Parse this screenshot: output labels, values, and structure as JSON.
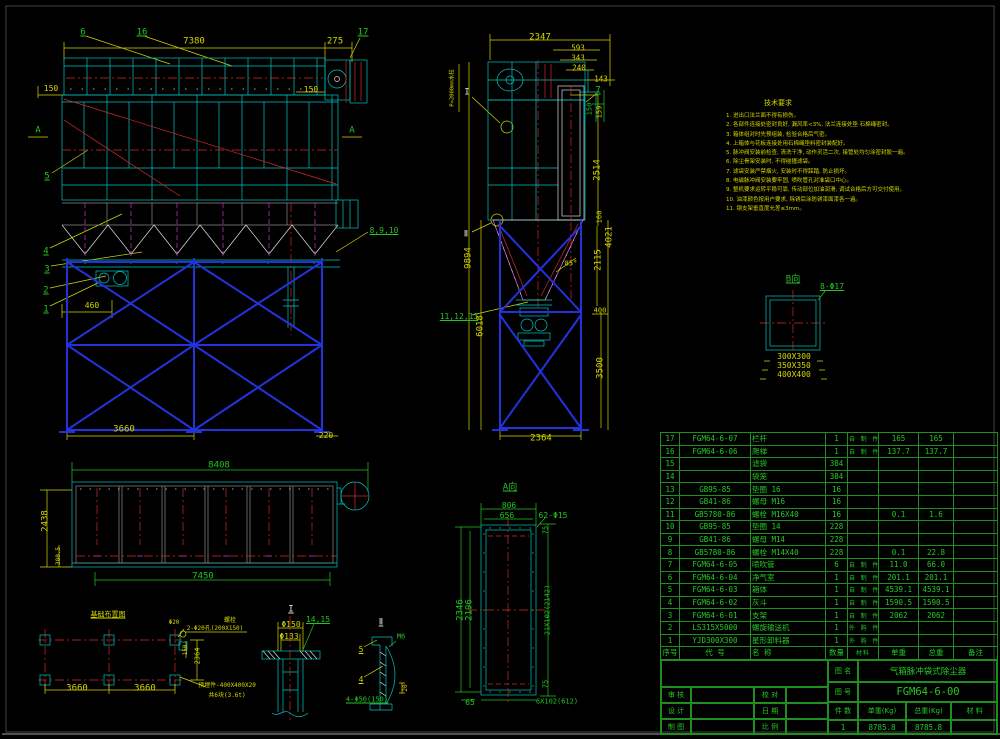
{
  "meta": {
    "drawing_no": "FGM64-6-00",
    "drawing_name": "气箱脉冲袋式除尘器",
    "colors": {
      "line_cyan": "#00c3c3",
      "dim_yellow": "#d6d600",
      "callout_green": "#22c522",
      "center_red": "#d42a2a",
      "frame_blue": "#2233dd",
      "hatch_magenta": "#cc33cc",
      "bg": "#000000"
    }
  },
  "notes": {
    "title": "技术要求",
    "items": [
      "1. 进出口法兰面不得有损伤。",
      "2. 各部件连接处密封良好, 漏风率<3%, 法兰连接处垫 石棉绳密封。",
      "3. 箱体组对时先预组装, 检验合格后气密。",
      "4. 上箱体与花板连接处用石棉绳垫料密封装配好。",
      "5. 脉冲阀安装前检查, 清洗干净, 动作灵活二次, 接管处均匀涂密封胶一遍。",
      "6. 除尘骨架安装时, 不得碰撞滤袋。",
      "7. 滤袋安装严禁烟火, 安装时不得踩踏, 防止损坏。",
      "8. 电磁脉冲阀安装要牢固, 喷吹管孔对准袋口中心。",
      "9. 整机要求运转平稳可靠, 传动部位加油润滑, 调试合格后方可交付使用。",
      "10. 油漆颜色按用户要求, 除锈后涂防锈漆面漆各一遍。",
      "11. 钢支架垂直度允差≤3mm。"
    ]
  },
  "parts_table": {
    "headers": [
      "序号",
      "代 号",
      "名 称",
      "数量",
      "材料",
      "单重",
      "总重",
      "备注"
    ],
    "rows": [
      [
        "17",
        "FGM64-6-07",
        "栏杆",
        "1",
        "自 制 件",
        "165",
        "165",
        ""
      ],
      [
        "16",
        "FGM64-6-06",
        "爬梯",
        "1",
        "自 制 件",
        "137.7",
        "137.7",
        ""
      ],
      [
        "15",
        "",
        "滤袋",
        "384",
        "",
        "",
        "",
        ""
      ],
      [
        "14",
        "",
        "袋笼",
        "384",
        "",
        "",
        "",
        ""
      ],
      [
        "13",
        "GB95-85",
        "垫圈 16",
        "16",
        "",
        "",
        "",
        ""
      ],
      [
        "12",
        "GB41-86",
        "螺母 M16",
        "16",
        "",
        "",
        "",
        ""
      ],
      [
        "11",
        "GB5780-86",
        "螺栓 M16X40",
        "16",
        "",
        "0.1",
        "1.6",
        ""
      ],
      [
        "10",
        "GB95-85",
        "垫圈 14",
        "228",
        "",
        "",
        "",
        ""
      ],
      [
        "9",
        "GB41-86",
        "螺母 M14",
        "228",
        "",
        "",
        "",
        ""
      ],
      [
        "8",
        "GB5780-86",
        "螺栓 M14X40",
        "228",
        "",
        "0.1",
        "22.8",
        ""
      ],
      [
        "7",
        "FGM64-6-05",
        "喷吹管",
        "6",
        "自 制 件",
        "11.0",
        "66.0",
        ""
      ],
      [
        "6",
        "FGM64-6-04",
        "净气室",
        "1",
        "自 制 件",
        "201.1",
        "201.1",
        ""
      ],
      [
        "5",
        "FGM64-6-03",
        "箱体",
        "1",
        "自 制 件",
        "4539.1",
        "4539.1",
        ""
      ],
      [
        "4",
        "FGM64-6-02",
        "灰斗",
        "1",
        "自 制 件",
        "1590.5",
        "1590.5",
        ""
      ],
      [
        "3",
        "FGM64-6-01",
        "支架",
        "1",
        "自 制 件",
        "2062",
        "2062",
        ""
      ],
      [
        "2",
        "LS315X5000",
        "螺旋输送机",
        "1",
        "外 购 件",
        "",
        "",
        ""
      ],
      [
        "1",
        "YJD300X300",
        "星形卸料器",
        "1",
        "外 购 件",
        "",
        "",
        ""
      ]
    ]
  },
  "title_block": {
    "drawing_name_label": "图 名",
    "drawing_name": "气箱脉冲袋式除尘器",
    "drawing_no_label": "图 号",
    "drawing_no": "FGM64-6-00",
    "review_label": "审 核",
    "proof_label": "校 对",
    "design_label": "设 计",
    "date_label": "日 期",
    "draft_label": "制 图",
    "scale_label": "比 例",
    "qty_label": "件 数",
    "unit_weight_label": "单重(Kg)",
    "total_weight_label": "总重(Kg)",
    "material_label": "材 料",
    "qty": "1",
    "unit_weight": "8785.8",
    "total_weight": "8785.8"
  },
  "labels": [
    {
      "n": "callout-6",
      "t": "6",
      "x": 83,
      "y": 33,
      "c": "g",
      "u": 1
    },
    {
      "n": "callout-16",
      "t": "16",
      "x": 142,
      "y": 33,
      "c": "g",
      "u": 1
    },
    {
      "n": "dim-7380",
      "t": "7380",
      "x": 194,
      "y": 42,
      "c": "y"
    },
    {
      "n": "dim-275",
      "t": "275",
      "x": 335,
      "y": 42,
      "c": "y"
    },
    {
      "n": "callout-17",
      "t": "17",
      "x": 363,
      "y": 33,
      "c": "g",
      "u": 1
    },
    {
      "n": "dim-150-left",
      "t": "150",
      "x": 51,
      "y": 89,
      "c": "y",
      "s": 8
    },
    {
      "n": "dim-150-right",
      "t": "150",
      "x": 311,
      "y": 90,
      "c": "y",
      "s": 8
    },
    {
      "n": "section-a-left",
      "t": "A",
      "x": 38,
      "y": 131,
      "c": "g"
    },
    {
      "n": "section-a-right",
      "t": "A",
      "x": 352,
      "y": 131,
      "c": "g"
    },
    {
      "n": "callout-5",
      "t": "5",
      "x": 47,
      "y": 177,
      "c": "g",
      "u": 1
    },
    {
      "n": "callout-4",
      "t": "4",
      "x": 46,
      "y": 252,
      "c": "g",
      "u": 1
    },
    {
      "n": "callout-3",
      "t": "3",
      "x": 47,
      "y": 270,
      "c": "g",
      "u": 1
    },
    {
      "n": "callout-2",
      "t": "2",
      "x": 46,
      "y": 291,
      "c": "g",
      "u": 1
    },
    {
      "n": "callout-1",
      "t": "1",
      "x": 46,
      "y": 310,
      "c": "g",
      "u": 1
    },
    {
      "n": "dim-460",
      "t": "460",
      "x": 92,
      "y": 306,
      "c": "y",
      "s": 8
    },
    {
      "n": "callout-8-9-10",
      "t": "8,9,10",
      "x": 384,
      "y": 231,
      "c": "g",
      "s": 8,
      "u": 1
    },
    {
      "n": "dim-3660-front",
      "t": "3660",
      "x": 124,
      "y": 430,
      "c": "y"
    },
    {
      "n": "dim-220",
      "t": "220",
      "x": 326,
      "y": 436,
      "c": "y",
      "s": 8
    },
    {
      "n": "dim-2347",
      "t": "2347",
      "x": 540,
      "y": 38,
      "c": "y"
    },
    {
      "n": "dim-593",
      "t": "593",
      "x": 578,
      "y": 48,
      "c": "y",
      "s": 7.5
    },
    {
      "n": "dim-343",
      "t": "343",
      "x": 578,
      "y": 58,
      "c": "y",
      "s": 7.5
    },
    {
      "n": "dim-240",
      "t": "240",
      "x": 579,
      "y": 68,
      "c": "y",
      "s": 7.5
    },
    {
      "n": "dim-143",
      "t": "143",
      "x": 601,
      "y": 79,
      "c": "y",
      "s": 7.5
    },
    {
      "n": "callout-7",
      "t": "7",
      "x": 598,
      "y": 91,
      "c": "g",
      "u": 1
    },
    {
      "n": "detail-marker-i",
      "t": "I",
      "x": 467,
      "y": 93,
      "c": "w"
    },
    {
      "n": "pressure-note",
      "t": "P=2000mm水柱",
      "x": 453,
      "y": 88,
      "c": "y",
      "r": 1,
      "s": 5.5
    },
    {
      "n": "dim-150-stack",
      "t": "150",
      "x": 590,
      "y": 109,
      "c": "g",
      "r": 1,
      "s": 7
    },
    {
      "n": "dim-159",
      "t": "159",
      "x": 600,
      "y": 112,
      "c": "y",
      "r": 1,
      "s": 7
    },
    {
      "n": "dim-2514",
      "t": "2514",
      "x": 598,
      "y": 170,
      "c": "y",
      "r": 1
    },
    {
      "n": "dim-160",
      "t": "160",
      "x": 600,
      "y": 217,
      "c": "y",
      "r": 1,
      "s": 7
    },
    {
      "n": "dim-4021",
      "t": "4021",
      "x": 610,
      "y": 237,
      "c": "y",
      "r": 1
    },
    {
      "n": "dim-2115",
      "t": "2115",
      "x": 599,
      "y": 260,
      "c": "y",
      "r": 1
    },
    {
      "n": "dim-85deg",
      "t": "85°",
      "x": 571,
      "y": 264,
      "c": "y",
      "s": 7
    },
    {
      "n": "dim-9894",
      "t": "9894",
      "x": 469,
      "y": 258,
      "c": "y",
      "r": 1
    },
    {
      "n": "detail-marker-ii",
      "t": "Ⅱ",
      "x": 466,
      "y": 235,
      "c": "w"
    },
    {
      "n": "callout-11-12-13",
      "t": "11,12,13",
      "x": 459,
      "y": 317,
      "c": "g",
      "s": 8,
      "u": 1
    },
    {
      "n": "dim-6018",
      "t": "6018",
      "x": 481,
      "y": 326,
      "c": "y",
      "r": 1
    },
    {
      "n": "dim-3500",
      "t": "3500",
      "x": 601,
      "y": 368,
      "c": "y",
      "r": 1
    },
    {
      "n": "dim-400",
      "t": "400",
      "x": 600,
      "y": 311,
      "c": "y",
      "s": 7
    },
    {
      "n": "dim-2364-side",
      "t": "2364",
      "x": 541,
      "y": 439,
      "c": "y"
    },
    {
      "n": "view-title-b",
      "t": "B向",
      "x": 793,
      "y": 280,
      "c": "g",
      "u": 1
    },
    {
      "n": "dim-8-d17",
      "t": "8-Φ17",
      "x": 832,
      "y": 287,
      "c": "g",
      "s": 8,
      "u": 1
    },
    {
      "n": "dim-300x300",
      "t": "300X300",
      "x": 794,
      "y": 357,
      "c": "y",
      "s": 8
    },
    {
      "n": "dim-350x350",
      "t": "350X350",
      "x": 794,
      "y": 366,
      "c": "y",
      "s": 8
    },
    {
      "n": "dim-400x400",
      "t": "400X400",
      "x": 794,
      "y": 375,
      "c": "y",
      "s": 8
    },
    {
      "n": "dim-8408",
      "t": "8408",
      "x": 219,
      "y": 466,
      "c": "g"
    },
    {
      "n": "dim-2438",
      "t": "2438",
      "x": 46,
      "y": 521,
      "c": "y",
      "r": 1
    },
    {
      "n": "dim-380-5",
      "t": "380.5",
      "x": 59,
      "y": 556,
      "c": "y",
      "r": 1,
      "s": 6
    },
    {
      "n": "dim-7450",
      "t": "7450",
      "x": 203,
      "y": 577,
      "c": "g"
    },
    {
      "n": "view-title-foundation",
      "t": "基础布置图",
      "x": 108,
      "y": 615,
      "c": "y",
      "s": 7,
      "u": 1
    },
    {
      "n": "dim-d20",
      "t": "Φ20",
      "x": 174,
      "y": 623,
      "c": "y",
      "s": 6
    },
    {
      "n": "note-bolt",
      "t": "螺栓",
      "x": 230,
      "y": 621,
      "c": "y",
      "s": 6
    },
    {
      "n": "note-holes",
      "t": "2-Φ20孔(200X150)",
      "x": 215,
      "y": 629,
      "c": "y",
      "s": 6
    },
    {
      "n": "dim-150-anchor",
      "t": "150",
      "x": 186,
      "y": 650,
      "c": "y",
      "r": 1,
      "s": 6
    },
    {
      "n": "dim-2364-fnd",
      "t": "2364",
      "x": 198,
      "y": 656,
      "c": "y",
      "r": 1,
      "s": 7
    },
    {
      "n": "dim-3660-a",
      "t": "3660",
      "x": 77,
      "y": 689,
      "c": "y"
    },
    {
      "n": "dim-3660-b",
      "t": "3660",
      "x": 145,
      "y": 689,
      "c": "y"
    },
    {
      "n": "note-embed-plate",
      "t": "预埋件-400X400X20",
      "x": 227,
      "y": 686,
      "c": "y",
      "s": 6
    },
    {
      "n": "note-embed-qty",
      "t": "共6块(3.6t)",
      "x": 227,
      "y": 696,
      "c": "y",
      "s": 6
    },
    {
      "n": "view-title-i",
      "t": "I",
      "x": 291,
      "y": 610,
      "c": "w",
      "u": 1
    },
    {
      "n": "dim-d150",
      "t": "Φ150",
      "x": 291,
      "y": 625,
      "c": "y",
      "s": 8
    },
    {
      "n": "dim-d133",
      "t": "Φ133",
      "x": 289,
      "y": 637,
      "c": "y",
      "s": 8
    },
    {
      "n": "callout-14-15",
      "t": "14,15",
      "x": 318,
      "y": 620,
      "c": "g",
      "s": 8,
      "u": 1
    },
    {
      "n": "view-title-ii",
      "t": "Ⅱ",
      "x": 381,
      "y": 623,
      "c": "w",
      "u": 1
    },
    {
      "n": "callout-5b",
      "t": "5",
      "x": 361,
      "y": 650,
      "c": "y",
      "s": 8,
      "u": 1
    },
    {
      "n": "callout-4b",
      "t": "4",
      "x": 361,
      "y": 680,
      "c": "y",
      "s": 8,
      "u": 1
    },
    {
      "n": "dim-m6",
      "t": "M6",
      "x": 401,
      "y": 637,
      "c": "g",
      "s": 7
    },
    {
      "n": "dim-4-d50",
      "t": "4-Φ50(150)",
      "x": 367,
      "y": 700,
      "c": "g",
      "s": 7,
      "u": 1
    },
    {
      "n": "dim-20",
      "t": "20",
      "x": 406,
      "y": 688,
      "c": "y",
      "r": 1,
      "s": 6
    },
    {
      "n": "view-title-a",
      "t": "A向",
      "x": 510,
      "y": 488,
      "c": "g",
      "u": 1
    },
    {
      "n": "dim-806",
      "t": "806",
      "x": 509,
      "y": 506,
      "c": "g",
      "s": 8
    },
    {
      "n": "dim-656",
      "t": "656",
      "x": 507,
      "y": 516,
      "c": "g",
      "s": 8
    },
    {
      "n": "dim-62-d15",
      "t": "62-Φ15",
      "x": 553,
      "y": 516,
      "c": "g",
      "s": 8
    },
    {
      "n": "dim-75-top",
      "t": "75",
      "x": 546,
      "y": 530,
      "c": "g",
      "r": 1,
      "s": 7
    },
    {
      "n": "dim-2346",
      "t": "2346",
      "x": 461,
      "y": 610,
      "c": "g",
      "r": 1
    },
    {
      "n": "dim-2196",
      "t": "2196",
      "x": 470,
      "y": 610,
      "c": "g",
      "r": 1
    },
    {
      "n": "dim-21x102",
      "t": "21X102(2142)",
      "x": 548,
      "y": 610,
      "c": "g",
      "r": 1,
      "s": 7
    },
    {
      "n": "dim-75-bot",
      "t": "75",
      "x": 546,
      "y": 684,
      "c": "g",
      "r": 1,
      "s": 7
    },
    {
      "n": "dim-65",
      "t": "65",
      "x": 470,
      "y": 703,
      "c": "g",
      "s": 8
    },
    {
      "n": "dim-6x102",
      "t": "6X102(612)",
      "x": 557,
      "y": 702,
      "c": "g",
      "s": 7
    }
  ]
}
